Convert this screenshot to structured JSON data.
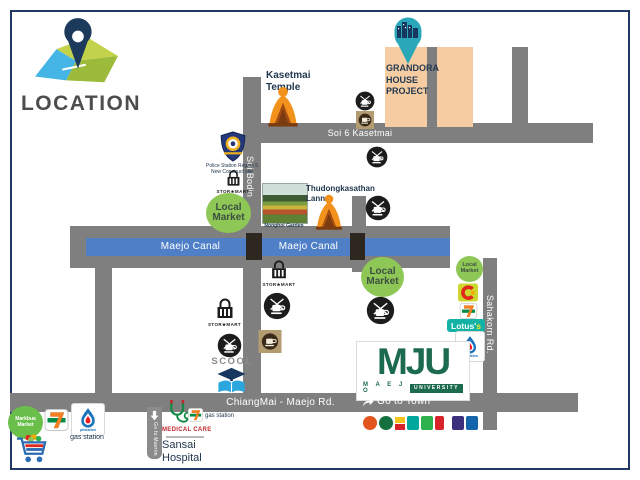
{
  "logo": {
    "title": "LOCATION"
  },
  "roads": {
    "soi_bodin": "Soi Bodin",
    "soi_6_kasetmai": "Soi 6 Kasetmai",
    "chiangmai_maejo": "ChiangMai - Maejo  Rd.",
    "sahakorn": "Sahakorn Rd.",
    "canal": "Maejo Canal"
  },
  "directions": {
    "go_to_town": "Go to Town",
    "go_to_maerim": "Go to Maerim"
  },
  "project": {
    "lines": [
      "GRANDORA",
      "HOUSE",
      "PROJECT"
    ]
  },
  "temples": {
    "kasetmai": [
      "Kasetmai",
      "Temple"
    ],
    "thudongkasathan": [
      "Thudongkasathan",
      "Lanna"
    ]
  },
  "places": {
    "police": [
      "Police Station Region 5",
      "New Construct site"
    ],
    "stormart": "STOR★MART",
    "local_market": [
      "Local",
      "Market"
    ],
    "nonghoi": "Nonghoi Garden",
    "scool": "SCOOL",
    "lotus": "Lotus'",
    "lotus_s": "s",
    "ptt": "pttstation",
    "gas_station": "gas station",
    "markbua": [
      "Markbua",
      "Market"
    ],
    "medical_care": "MEDICAL CARE",
    "sansai": [
      "Sansai",
      "Hospital"
    ]
  },
  "mju": {
    "initials": "MJU",
    "maejo": "M A E J O",
    "university": "UNIVERSITY"
  },
  "colors": {
    "road": "#7f7f7f",
    "canal": "#4f80c7",
    "project_area": "#f6cda3",
    "navy_text": "#22384f",
    "mju_green": "#1d6b4e",
    "pin_teal": "#2aa7b8"
  }
}
